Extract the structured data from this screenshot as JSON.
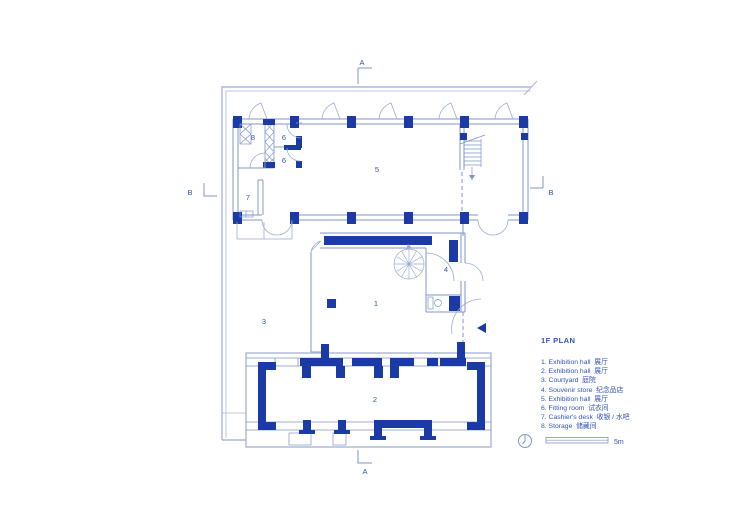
{
  "colors": {
    "wall_fill": "#1b3aa6",
    "line": "#8094c8",
    "boundary": "#aab7d9",
    "text": "#3354b4",
    "background": "#ffffff"
  },
  "plan": {
    "rooms": {
      "r1": "1",
      "r2": "2",
      "r3": "3",
      "r4": "4",
      "r5": "5",
      "r6a": "6",
      "r6b": "6",
      "r7": "7",
      "r8": "8"
    },
    "markers": {
      "section_a": "A",
      "section_b": "B"
    },
    "scale_label": "5m",
    "compass_icon": "north-indicator"
  },
  "legend": {
    "title": "1F PLAN",
    "items": [
      "1. Exhibition hall  展厅",
      "2. Exhibition hall  展厅",
      "3. Courtyard  庭院",
      "4. Souvenir store  纪念品店",
      "5. Exhibition hall  展厅",
      "6. Fitting room  试衣间",
      "7. Cashier's desk  收银 / 水吧",
      "8. Storage  储藏间"
    ]
  }
}
